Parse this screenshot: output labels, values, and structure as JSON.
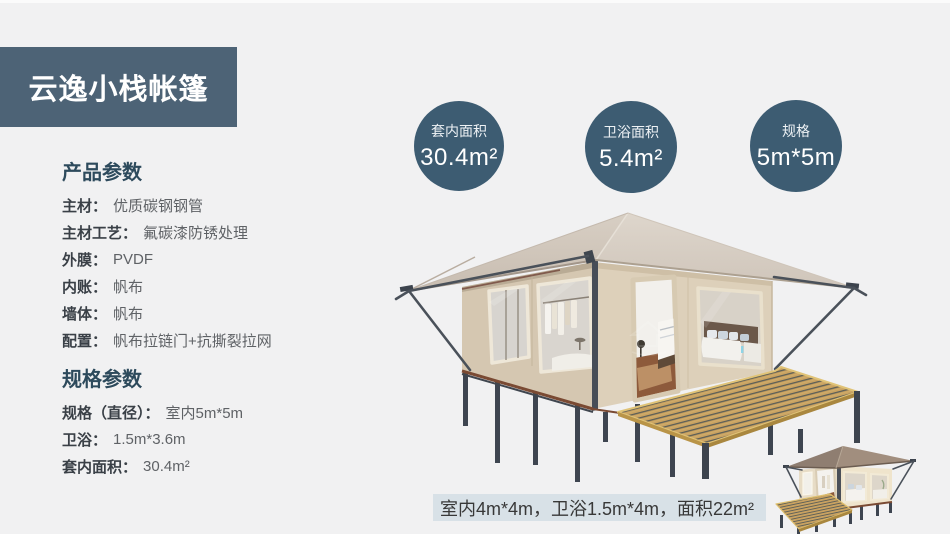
{
  "page": {
    "bg": "#f1f1f2"
  },
  "header": {
    "title": "云逸小栈帐篷"
  },
  "stat_circles": [
    {
      "label": "套内面积",
      "value": "30.4m²"
    },
    {
      "label": "卫浴面积",
      "value": "5.4m²"
    },
    {
      "label": "规格",
      "value": "5m*5m"
    }
  ],
  "product_params": {
    "heading": "产品参数",
    "rows": [
      {
        "label": "主材：",
        "value": "优质碳钢钢管"
      },
      {
        "label": "主材工艺：",
        "value": "氟碳漆防锈处理"
      },
      {
        "label": "外膜：",
        "value": "PVDF"
      },
      {
        "label": "内账：",
        "value": "帆布"
      },
      {
        "label": "墙体：",
        "value": "帆布"
      },
      {
        "label": "配置：",
        "value": "帆布拉链门+抗撕裂拉网"
      }
    ]
  },
  "spec_params": {
    "heading": "规格参数",
    "rows": [
      {
        "label": "规格（直径）：",
        "value": "室内5m*5m"
      },
      {
        "label": "卫浴：",
        "value": "1.5m*3.6m"
      },
      {
        "label": "套内面积：",
        "value": "30.4m²"
      }
    ]
  },
  "caption": {
    "text": "室内4m*4m，卫浴1.5m*4m，面积22m²"
  },
  "illustrations": {
    "main_tent": "野奢帐篷效果图",
    "small_tent": "小型帐篷效果图"
  },
  "colors": {
    "accent_circle": "#3d5c72",
    "header_bg": "#4d6376",
    "heading_text": "#2d4a5c",
    "caption_bg": "#d8e1e7",
    "page_bg": "#f1f1f2",
    "label_text": "#3a4047",
    "value_text": "#5f6266"
  }
}
